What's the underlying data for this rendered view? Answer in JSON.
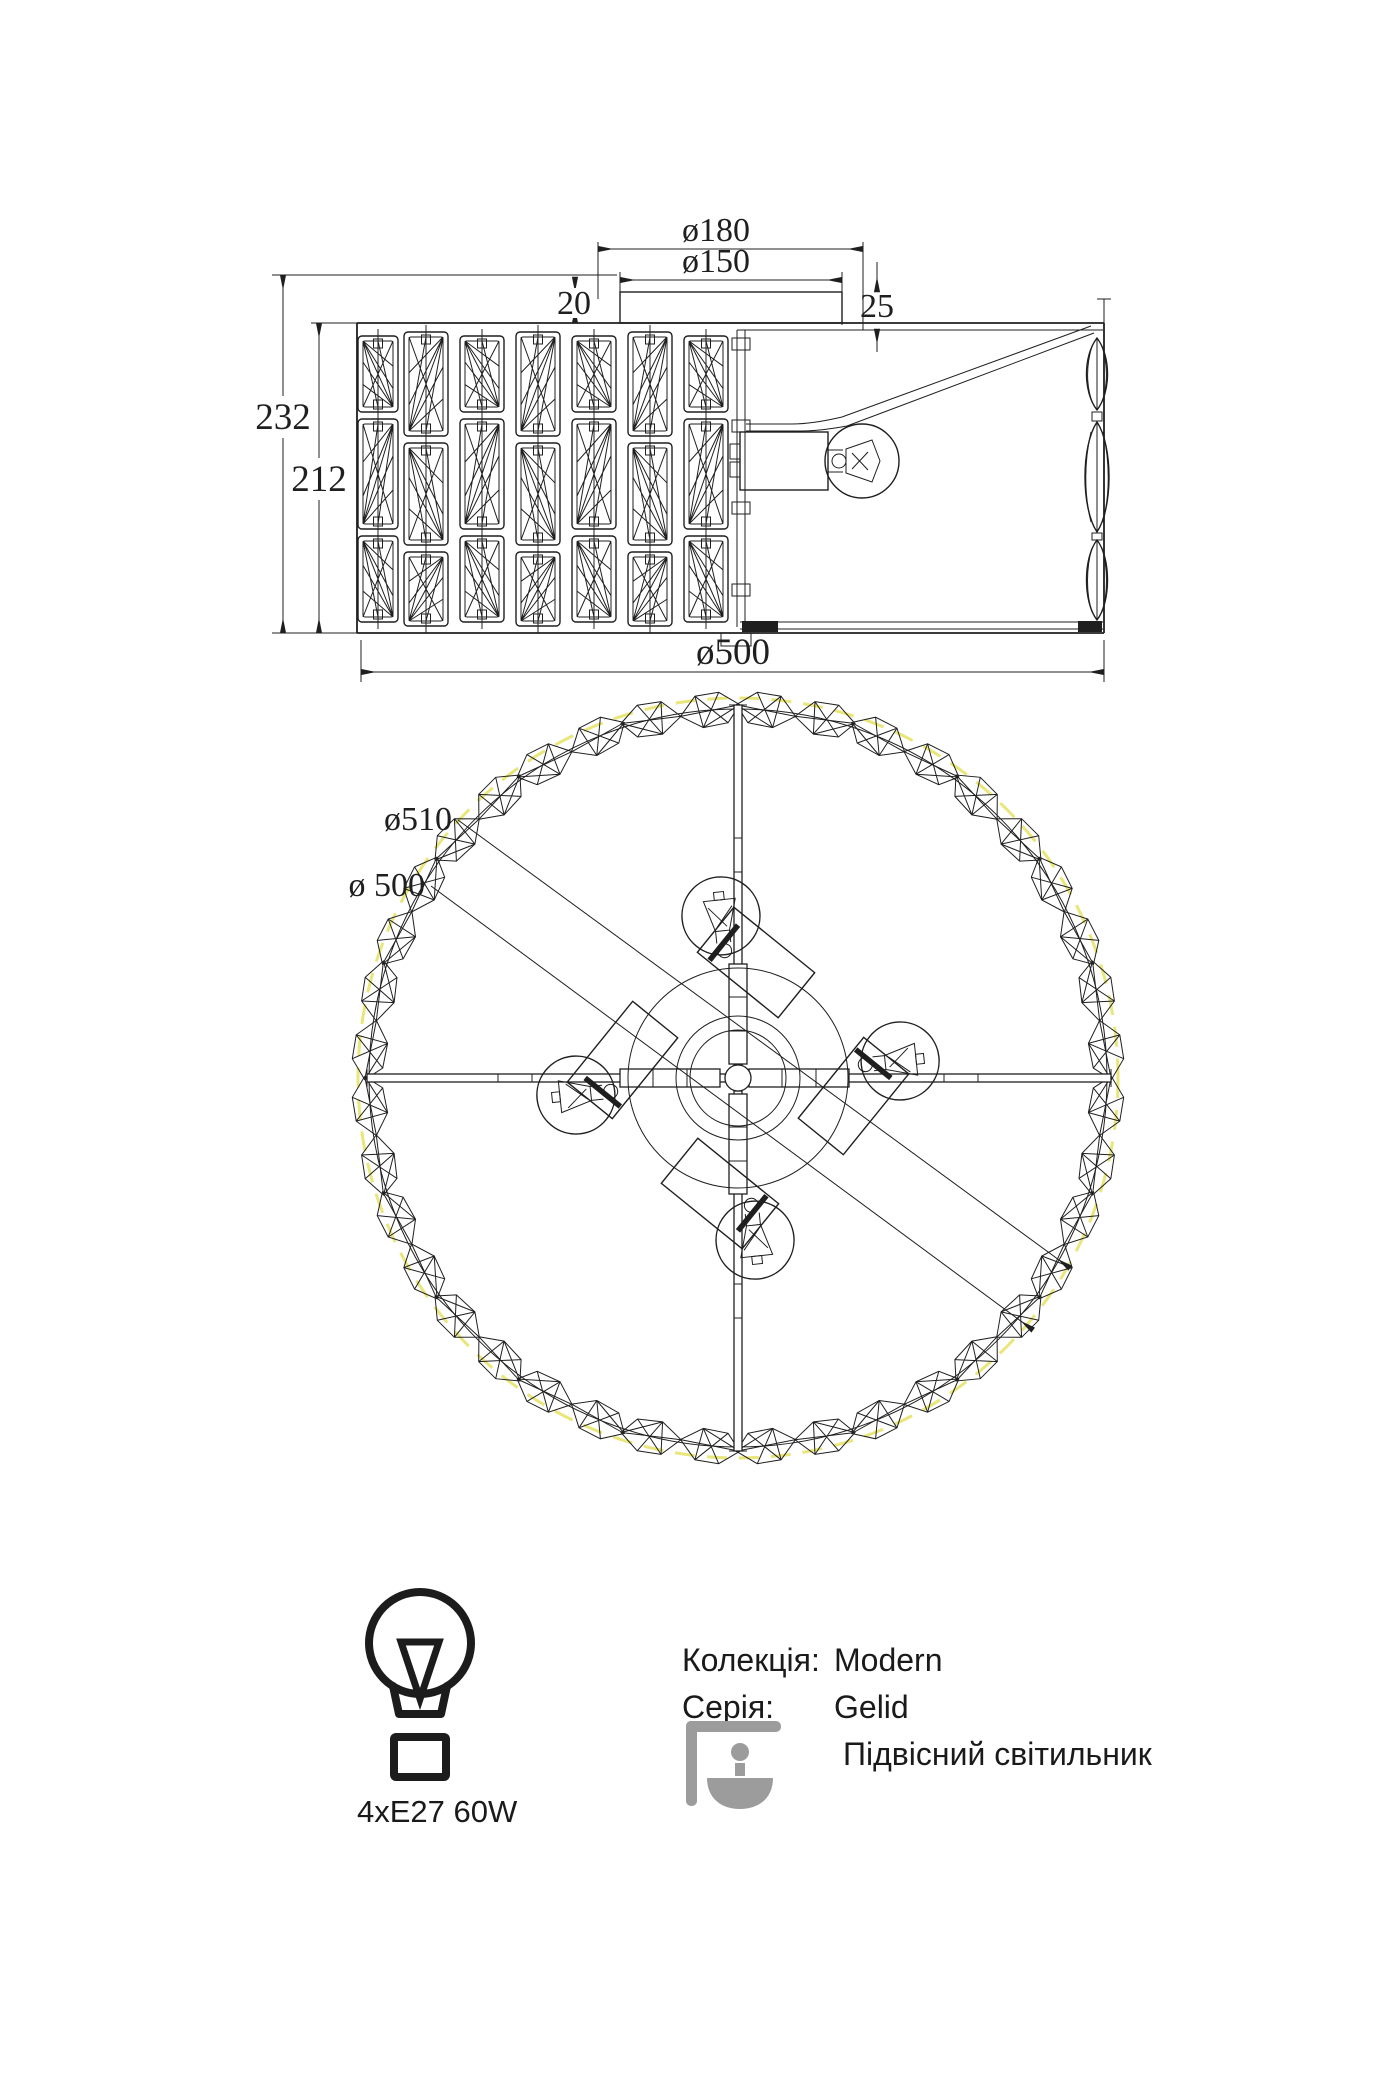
{
  "palette": {
    "line_color": "#1f1f1f",
    "dashed_circle_yellow": "#e9e67b",
    "icon_gray": "#9c9c9c",
    "background": "#ffffff"
  },
  "side_view": {
    "dim_top_outer": "ø180",
    "dim_top_inner": "ø150",
    "dim_gap_left": "20",
    "dim_gap_right": "25",
    "dim_height_total": "232",
    "dim_height_shade": "212",
    "dim_width": "ø500"
  },
  "bottom_view": {
    "dim_outer": "ø510",
    "dim_inner": "ø 500"
  },
  "spec": {
    "bulb_spec": "4xE27 60W"
  },
  "info": {
    "collection_label": "Колекція:",
    "collection_value": "Modern",
    "series_label": "Серія:",
    "series_value": "Gelid",
    "type_value": "Підвісний світильник"
  },
  "drawing": {
    "crystal_columns": 7,
    "crystal_rows": 3,
    "ring_gems": 40,
    "bulb_count": 4
  }
}
